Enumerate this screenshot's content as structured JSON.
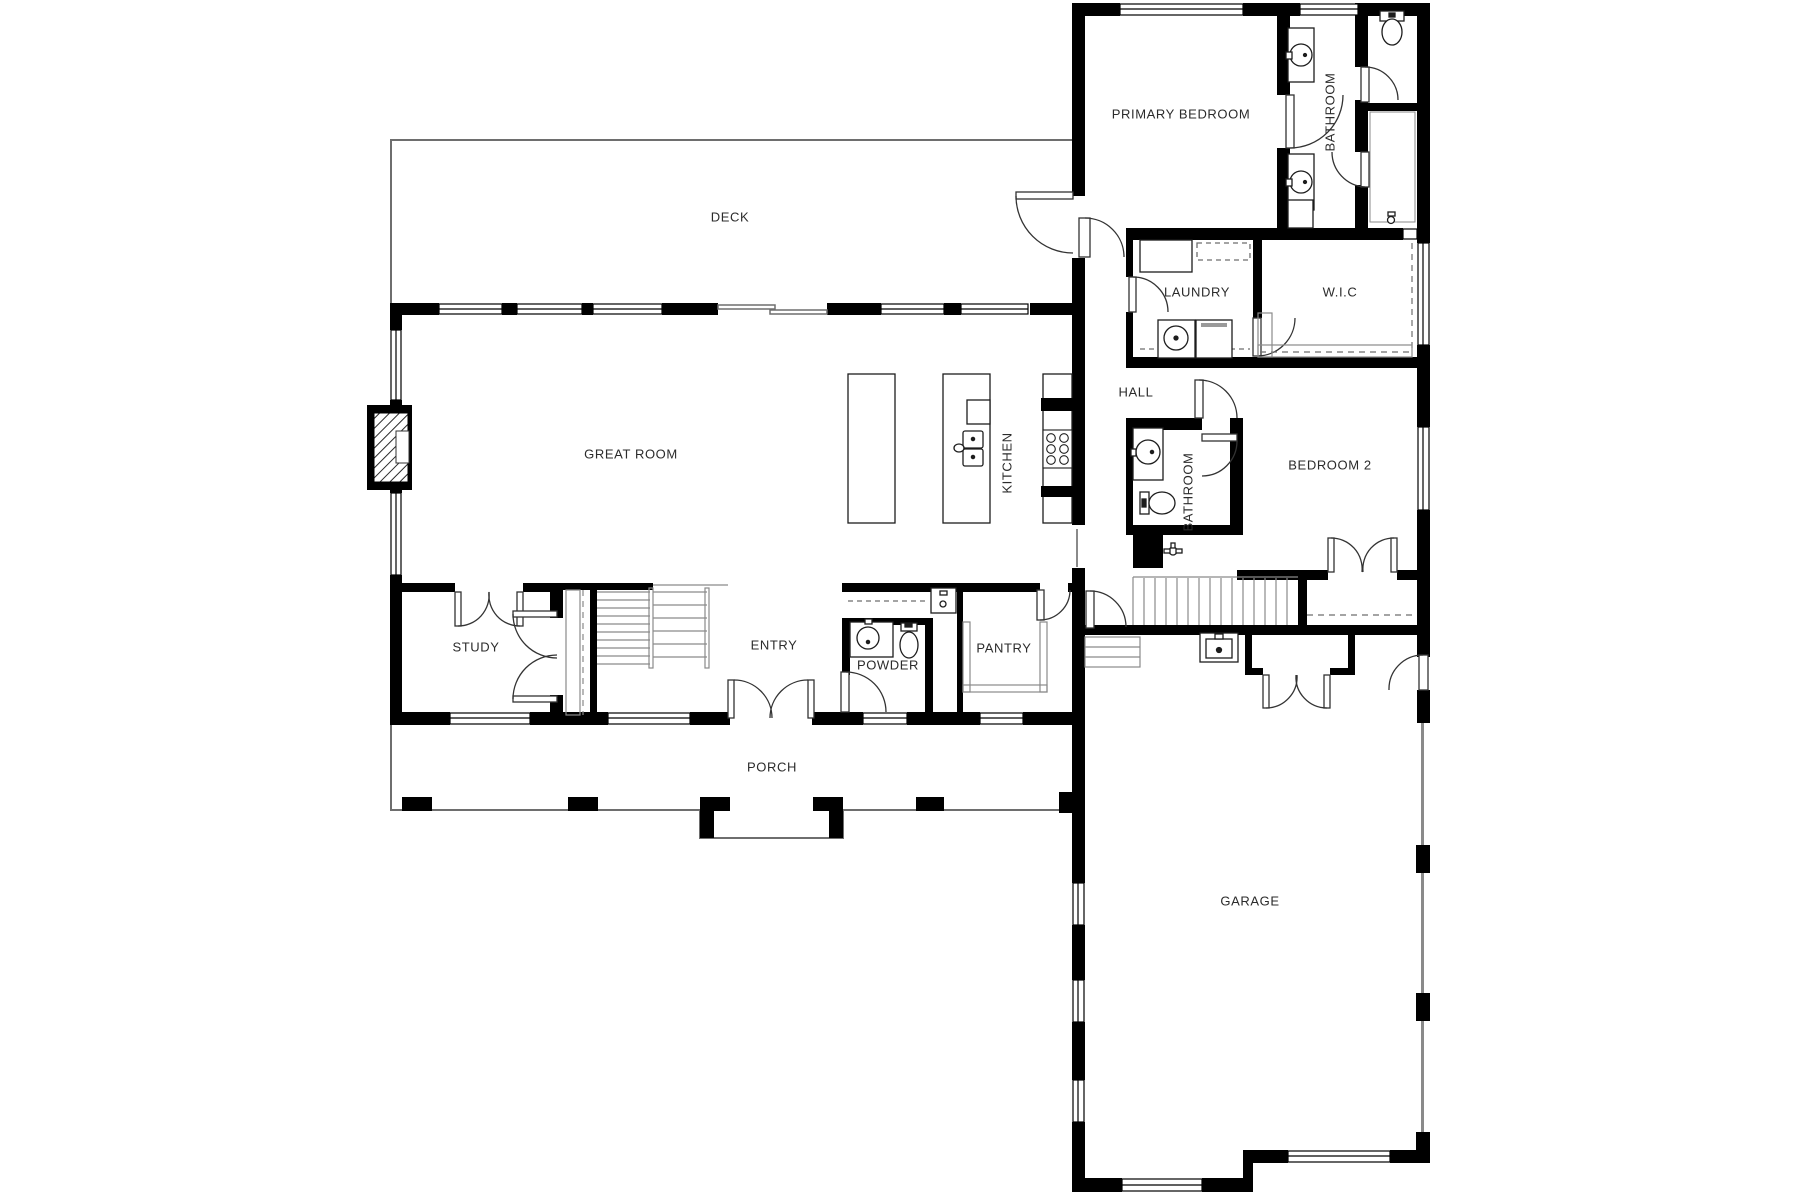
{
  "plan": {
    "colors": {
      "wall": "#000000",
      "thin_line": "#6e6e6e",
      "fixture_line": "#1d1d1d",
      "label": "#2b2b2b",
      "background": "#ffffff"
    },
    "rooms": [
      {
        "id": "deck",
        "label": "DECK"
      },
      {
        "id": "primary-bedroom",
        "label": "PRIMARY BEDROOM"
      },
      {
        "id": "primary-bathroom",
        "label": "BATHROOM"
      },
      {
        "id": "laundry",
        "label": "LAUNDRY"
      },
      {
        "id": "wic",
        "label": "W.I.C"
      },
      {
        "id": "hall",
        "label": "HALL"
      },
      {
        "id": "great-room",
        "label": "GREAT ROOM"
      },
      {
        "id": "kitchen",
        "label": "KITCHEN"
      },
      {
        "id": "hall-bathroom",
        "label": "BATHROOM"
      },
      {
        "id": "bedroom-2",
        "label": "BEDROOM 2"
      },
      {
        "id": "study",
        "label": "STUDY"
      },
      {
        "id": "entry",
        "label": "ENTRY"
      },
      {
        "id": "powder",
        "label": "POWDER"
      },
      {
        "id": "pantry",
        "label": "PANTRY"
      },
      {
        "id": "porch",
        "label": "PORCH"
      },
      {
        "id": "garage",
        "label": "GARAGE"
      }
    ]
  }
}
